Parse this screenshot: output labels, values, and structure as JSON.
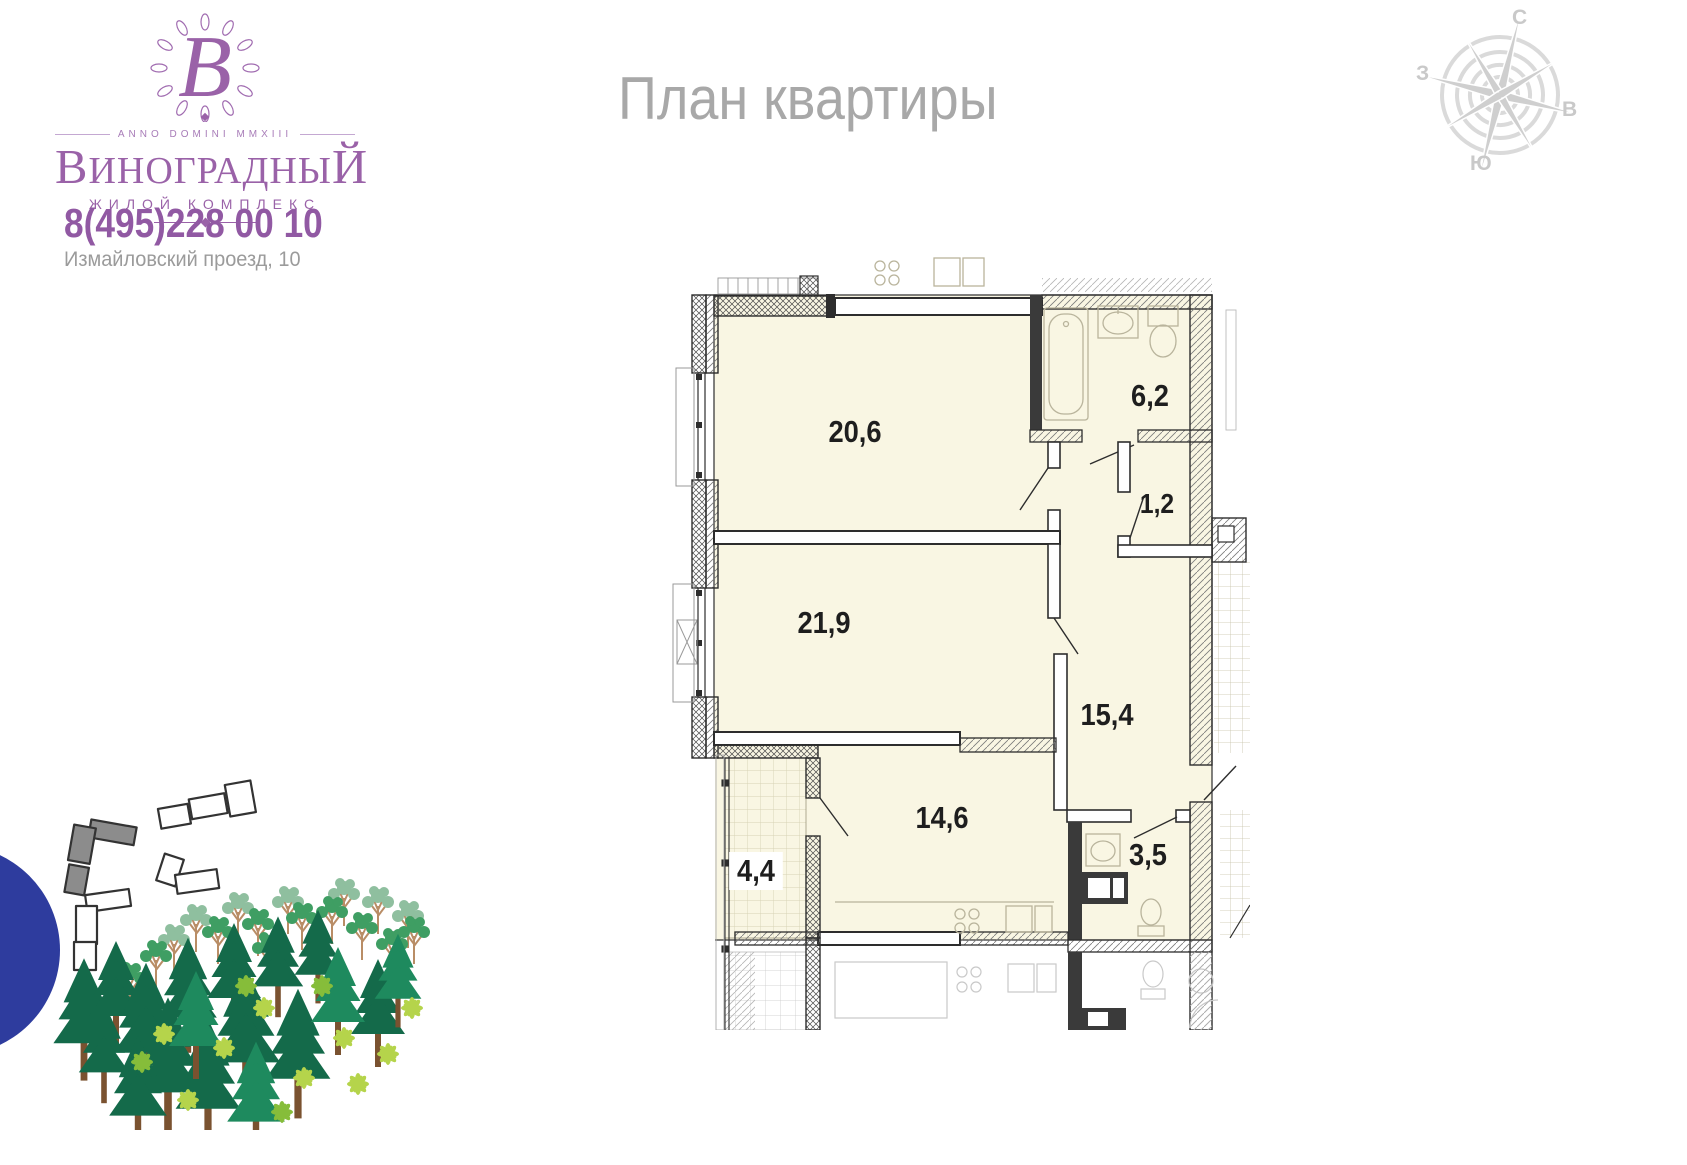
{
  "brand": {
    "monogram_letter": "В",
    "anno": "ANNO DOMINI MMXIII",
    "name_main": "ВИНОГРАДНЫ",
    "name_last": "Й",
    "subtitle": "ЖИЛОЙ КОМПЛЕКС",
    "phone": "8(495)228 00 10",
    "address": "Измайловский проезд, 10",
    "accent_color": "#9a62a8"
  },
  "page": {
    "title": "План квартиры",
    "title_color": "#a8a8a8",
    "background": "#ffffff"
  },
  "compass": {
    "north": "С",
    "south": "Ю",
    "west": "З",
    "east": "В",
    "color": "#d5d5d5"
  },
  "floor_plan": {
    "room_fill": "#f9f6e3",
    "wall_color": "#2d2d2d",
    "fixture_color": "#b9b49c",
    "rooms": [
      {
        "name": "living-room",
        "area": "20,6"
      },
      {
        "name": "bedroom",
        "area": "21,9"
      },
      {
        "name": "kitchen",
        "area": "14,6"
      },
      {
        "name": "hallway",
        "area": "15,4"
      },
      {
        "name": "bathroom",
        "area": "6,2"
      },
      {
        "name": "wc",
        "area": "3,5"
      },
      {
        "name": "balcony",
        "area": "4,4"
      },
      {
        "name": "closet",
        "area": "1,2"
      }
    ],
    "fixtures": [
      "bathtub",
      "sink",
      "toilet",
      "stove",
      "kitchen-counter",
      "air-conditioner"
    ]
  },
  "site_plan": {
    "marker_color": "#2e3c9e",
    "highlighted_building_color": "#8c8c8c",
    "tree_colors": {
      "pine_dark": "#146a4a",
      "pine_mid": "#1e8a5e",
      "deciduous": "#3f9e63",
      "deciduous_light": "#8fbf9f",
      "bush": "#b5d44b",
      "trunk": "#b98d66"
    }
  }
}
